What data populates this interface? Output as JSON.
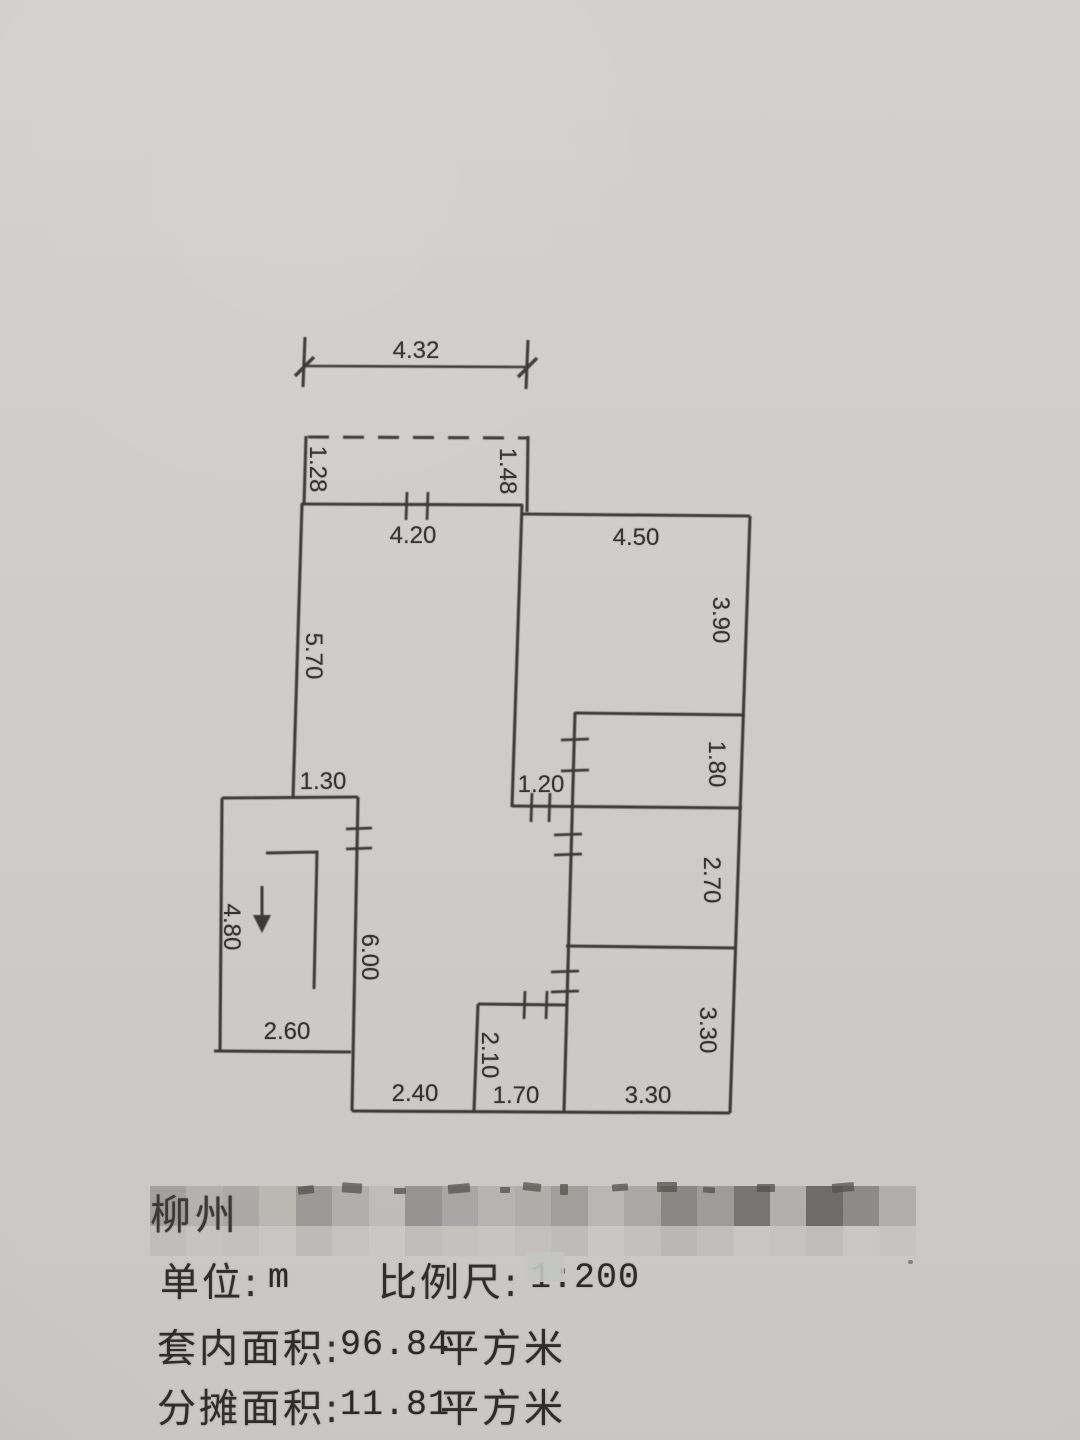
{
  "colors": {
    "paper": "#d2d0ce",
    "ink": "#3b3936",
    "text": "#33312e"
  },
  "floor_plan": {
    "unit": "m",
    "stair_direction": "down",
    "dimensions": [
      "4.32",
      "1.28",
      "1.48",
      "4.20",
      "4.50",
      "5.70",
      "3.90",
      "1.80",
      "1.30",
      "1.20",
      "2.70",
      "4.80",
      "6.00",
      "2.60",
      "3.30",
      "2.10",
      "2.40",
      "1.70",
      "3.30"
    ]
  },
  "footer": {
    "address_visible_fragment": "柳州",
    "address_redacted": true,
    "unit_label": "单位:",
    "unit_value": "m",
    "scale_label": "比例尺:",
    "scale_value": "1:200",
    "inner_area_label": "套内面积:",
    "inner_area_number": "96.84",
    "inner_area_unit": "平方米",
    "shared_area_label": "分摊面积:",
    "shared_area_number": "11.81",
    "shared_area_unit": "平方米"
  },
  "redaction_mosaic": {
    "row1": [
      "#a8a5a3",
      "#bab7b5",
      "#b1aeac",
      "#c1beba",
      "#a19e9c",
      "#b7b4b2",
      "#c5c2c0",
      "#9b9896",
      "#aeabab",
      "#bcb9b7",
      "#b5b2b0",
      "#a6a3a1",
      "#bfbcba",
      "#b0adab",
      "#8e8b89",
      "#a3a09e",
      "#7a7876",
      "#b8b5b3",
      "#716f6d",
      "#918e8c",
      "#b6b3b1"
    ],
    "row2": [
      "#c5c2c0",
      "#cdcac8",
      "#c8c5c3",
      "#cfccca",
      "#c1bebc",
      "#cbc8c6",
      "#d1cecc",
      "#c4c1bf",
      "#cac7c5",
      "#cecbc9",
      "#c7c4c2",
      "#c3c0be",
      "#d0cdcb",
      "#c9c6c4",
      "#bebbb9",
      "#c6c3c1",
      "#cfccca",
      "#cbc8c6",
      "#c5c2c0",
      "#d1cecc",
      "#ccc9c7"
    ]
  }
}
